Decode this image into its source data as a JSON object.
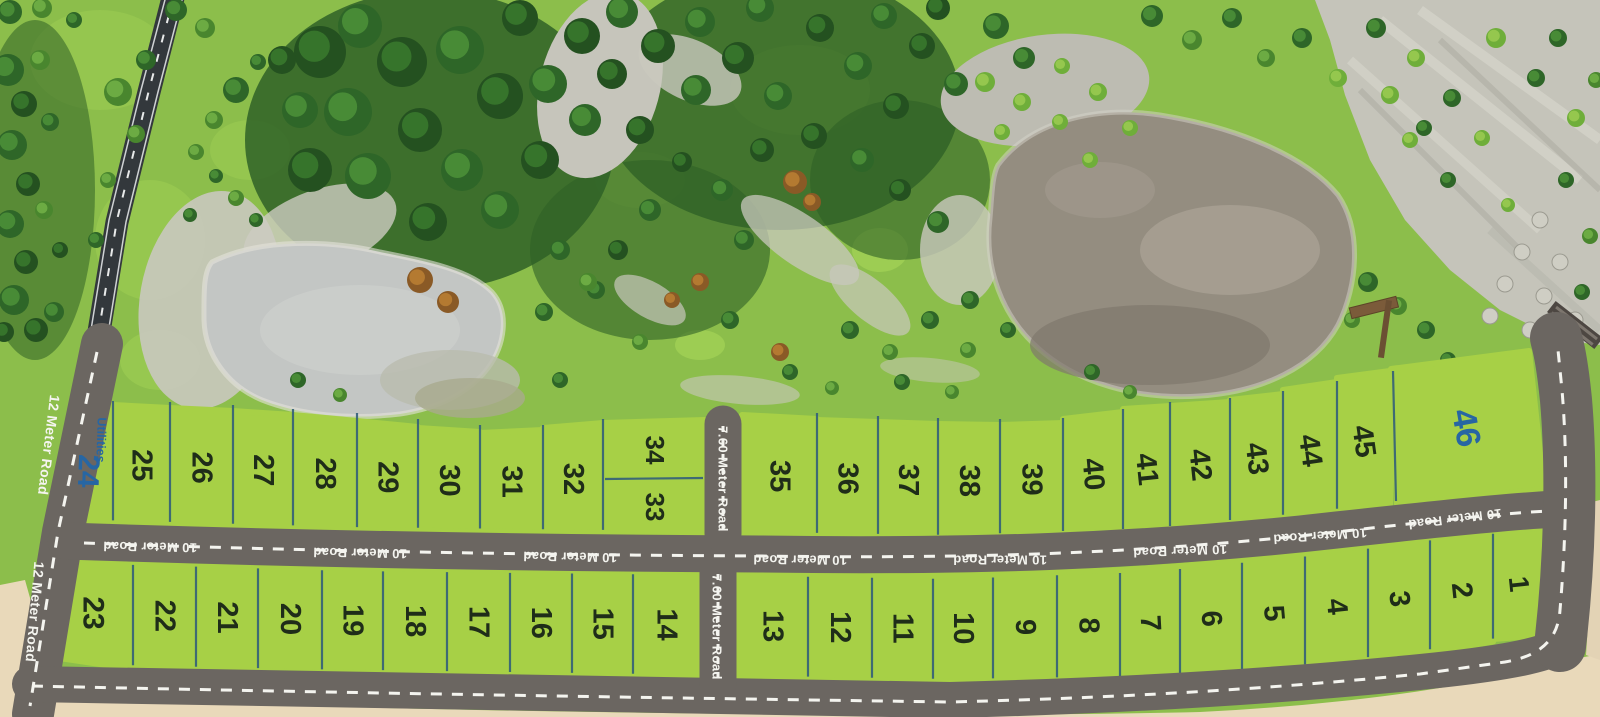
{
  "image_type": "Aerial 3D master plan of residential plot layout with 46 numbered plots",
  "roads": {
    "road_12m": "12 Meter Road",
    "road_10m": "10 Meter Road",
    "road_760m": "7.60 Meter Road"
  },
  "plot_sublabels": {
    "utilities": "Utilities"
  },
  "plots": {
    "top_row": [
      "24",
      "25",
      "26",
      "27",
      "28",
      "29",
      "30",
      "31",
      "32",
      "34",
      "33",
      "35",
      "36",
      "37",
      "38",
      "39",
      "40",
      "41",
      "42",
      "43",
      "44",
      "45",
      "46"
    ],
    "bottom_row": [
      "23",
      "22",
      "21",
      "20",
      "19",
      "18",
      "17",
      "16",
      "15",
      "14",
      "13",
      "12",
      "11",
      "10",
      "9",
      "8",
      "7",
      "6",
      "5",
      "4",
      "3",
      "2",
      "1"
    ],
    "special_blue": [
      "24",
      "46"
    ],
    "total_count": 46
  },
  "colors": {
    "plot_green": "#a7d046",
    "plot_number": "#1f2d19",
    "special_number_blue": "#2766a3",
    "road_gray": "#6b6661",
    "road_3d_dark": "#33383c",
    "road_dash_white": "#f4f4ef",
    "divider_teal": "#33607a",
    "sand": "#e9d9ba",
    "water_pond": "#c3c6c4",
    "water_lake": "#948d80",
    "grass": "#8cbe4b"
  }
}
